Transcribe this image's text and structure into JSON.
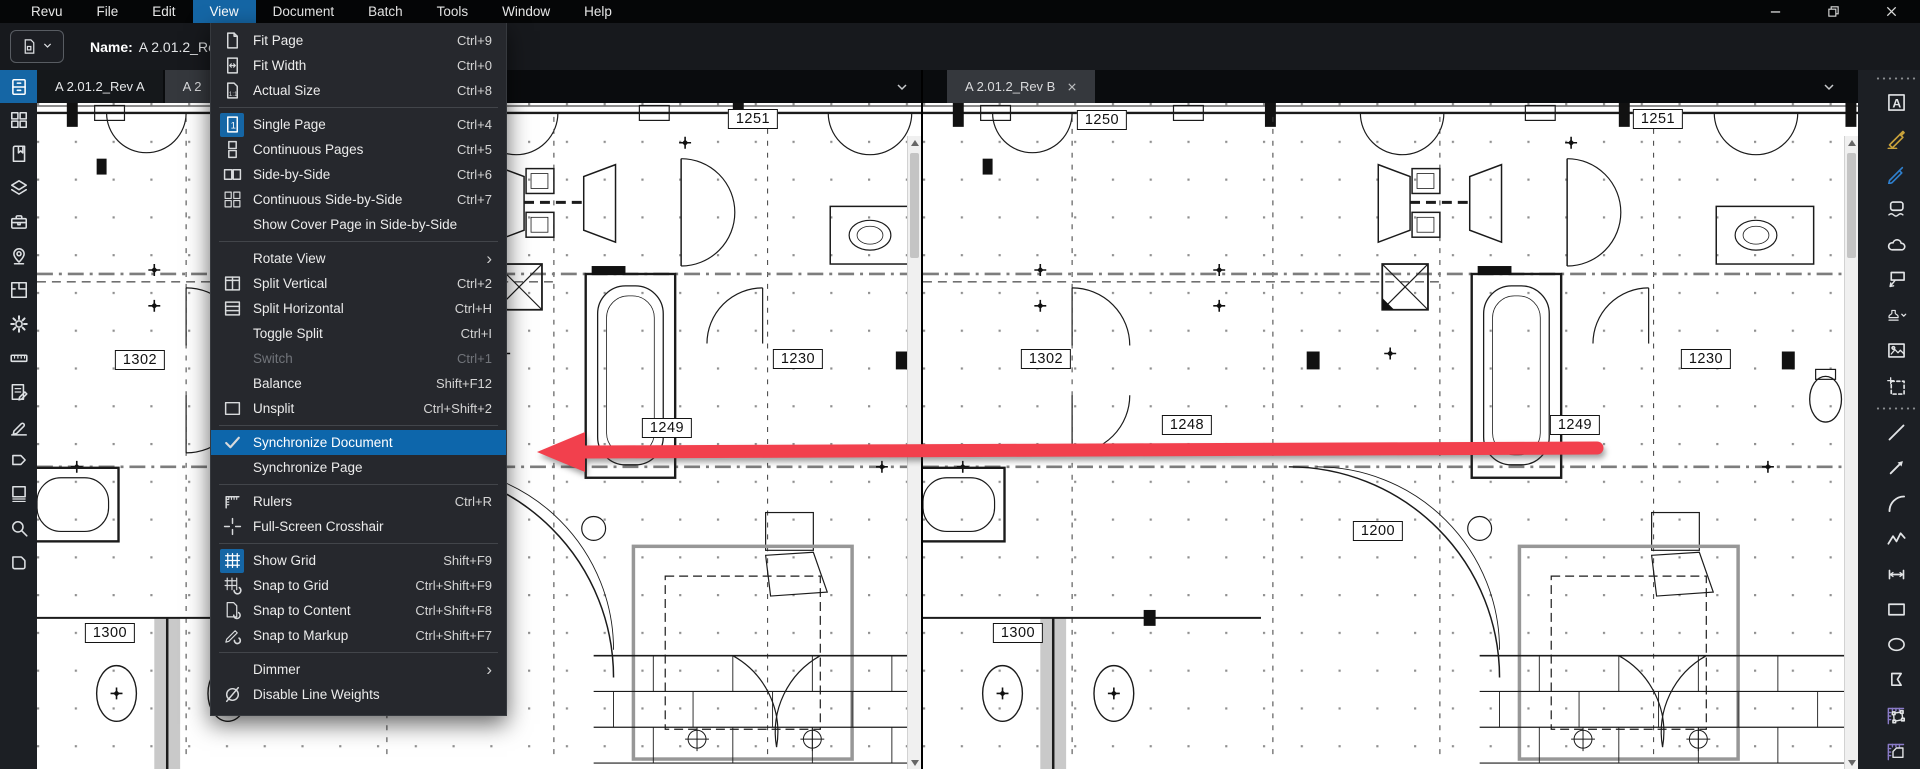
{
  "menubar": {
    "items": [
      "Revu",
      "File",
      "Edit",
      "View",
      "Document",
      "Batch",
      "Tools",
      "Window",
      "Help"
    ],
    "active_index": 3
  },
  "window_controls": {
    "buttons": [
      "minimize",
      "restore",
      "close"
    ]
  },
  "toolbar": {
    "name_label": "Name:",
    "name_value": "A 2.01.2_Rev"
  },
  "view_menu": {
    "items": [
      {
        "label": "Fit Page",
        "shortcut": "Ctrl+9",
        "icon": "fit-page"
      },
      {
        "label": "Fit Width",
        "shortcut": "Ctrl+0",
        "icon": "fit-width"
      },
      {
        "label": "Actual Size",
        "shortcut": "Ctrl+8",
        "icon": "actual-size"
      },
      {
        "separator": true
      },
      {
        "label": "Single Page",
        "shortcut": "Ctrl+4",
        "icon": "single-page",
        "icon_active": true
      },
      {
        "label": "Continuous Pages",
        "shortcut": "Ctrl+5",
        "icon": "continuous-pages"
      },
      {
        "label": "Side-by-Side",
        "shortcut": "Ctrl+6",
        "icon": "side-by-side"
      },
      {
        "label": "Continuous Side-by-Side",
        "shortcut": "Ctrl+7",
        "icon": "continuous-side-by-side"
      },
      {
        "label": "Show Cover Page in Side-by-Side"
      },
      {
        "separator": true
      },
      {
        "label": "Rotate View",
        "submenu": true
      },
      {
        "label": "Split Vertical",
        "shortcut": "Ctrl+2",
        "icon": "split-vertical"
      },
      {
        "label": "Split Horizontal",
        "shortcut": "Ctrl+H",
        "icon": "split-horizontal"
      },
      {
        "label": "Toggle Split",
        "shortcut": "Ctrl+I"
      },
      {
        "label": "Switch",
        "shortcut": "Ctrl+1",
        "disabled": true
      },
      {
        "label": "Balance",
        "shortcut": "Shift+F12"
      },
      {
        "label": "Unsplit",
        "shortcut": "Ctrl+Shift+2",
        "icon": "unsplit"
      },
      {
        "separator": true
      },
      {
        "label": "Synchronize Document",
        "icon": "check",
        "highlighted": true
      },
      {
        "label": "Synchronize Page"
      },
      {
        "separator": true
      },
      {
        "label": "Rulers",
        "shortcut": "Ctrl+R",
        "icon": "rulers"
      },
      {
        "label": "Full-Screen Crosshair",
        "icon": "crosshair"
      },
      {
        "separator": true
      },
      {
        "label": "Show Grid",
        "shortcut": "Shift+F9",
        "icon": "show-grid",
        "icon_active": true
      },
      {
        "label": "Snap to Grid",
        "shortcut": "Ctrl+Shift+F9",
        "icon": "snap-to-grid"
      },
      {
        "label": "Snap to Content",
        "shortcut": "Ctrl+Shift+F8",
        "icon": "snap-to-content"
      },
      {
        "label": "Snap to Markup",
        "shortcut": "Ctrl+Shift+F7",
        "icon": "snap-to-markup"
      },
      {
        "separator": true
      },
      {
        "label": "Dimmer",
        "submenu": true
      },
      {
        "label": "Disable Line Weights",
        "icon": "disable-line-weights"
      }
    ]
  },
  "left_sidebar": {
    "active": "file-access",
    "panels": [
      "file-access",
      "thumbnails",
      "bookmarks",
      "layers",
      "tool-chest",
      "places",
      "spaces",
      "properties",
      "measurements",
      "markups",
      "signature",
      "tag",
      "pages",
      "search",
      "links"
    ]
  },
  "right_sidebar": {
    "tools": [
      "text",
      "highlight",
      "pen",
      "eraser",
      "cloud",
      "callout",
      "stamp",
      "image",
      "snapshot",
      "separator",
      "line",
      "arrow",
      "arc",
      "polyline",
      "dimension",
      "rectangle",
      "ellipse",
      "polygon",
      "measure-polygon",
      "measure-area"
    ]
  },
  "panes": [
    {
      "tab": "A 2.01.2_Rev A",
      "partial_tab": "A 2",
      "labels": [
        {
          "text": "1250",
          "x": 259,
          "y": 17
        },
        {
          "text": "1251",
          "x": 716,
          "y": 16
        },
        {
          "text": "1302",
          "x": 103,
          "y": 257
        },
        {
          "text": "1230",
          "x": 761,
          "y": 256
        },
        {
          "text": "1249",
          "x": 630,
          "y": 325
        },
        {
          "text": "1300",
          "x": 73,
          "y": 530
        }
      ]
    },
    {
      "tab": "A 2.01.2_Rev B",
      "labels": [
        {
          "text": "1250",
          "x": 179,
          "y": 17
        },
        {
          "text": "1251",
          "x": 735,
          "y": 16
        },
        {
          "text": "1302",
          "x": 123,
          "y": 256
        },
        {
          "text": "1230",
          "x": 783,
          "y": 256
        },
        {
          "text": "1248",
          "x": 264,
          "y": 322
        },
        {
          "text": "1249",
          "x": 652,
          "y": 322
        },
        {
          "text": "1200",
          "x": 455,
          "y": 428
        },
        {
          "text": "1300",
          "x": 95,
          "y": 530
        }
      ]
    }
  ],
  "colors": {
    "accent_blue": "#1566a5",
    "menu_highlight": "#0d66ab",
    "annotation_arrow_red": "#f2404d",
    "highlighter_gold": "#c9a23b",
    "pen_blue": "#2f80cf",
    "measure_purple": "#8a7bc8"
  }
}
